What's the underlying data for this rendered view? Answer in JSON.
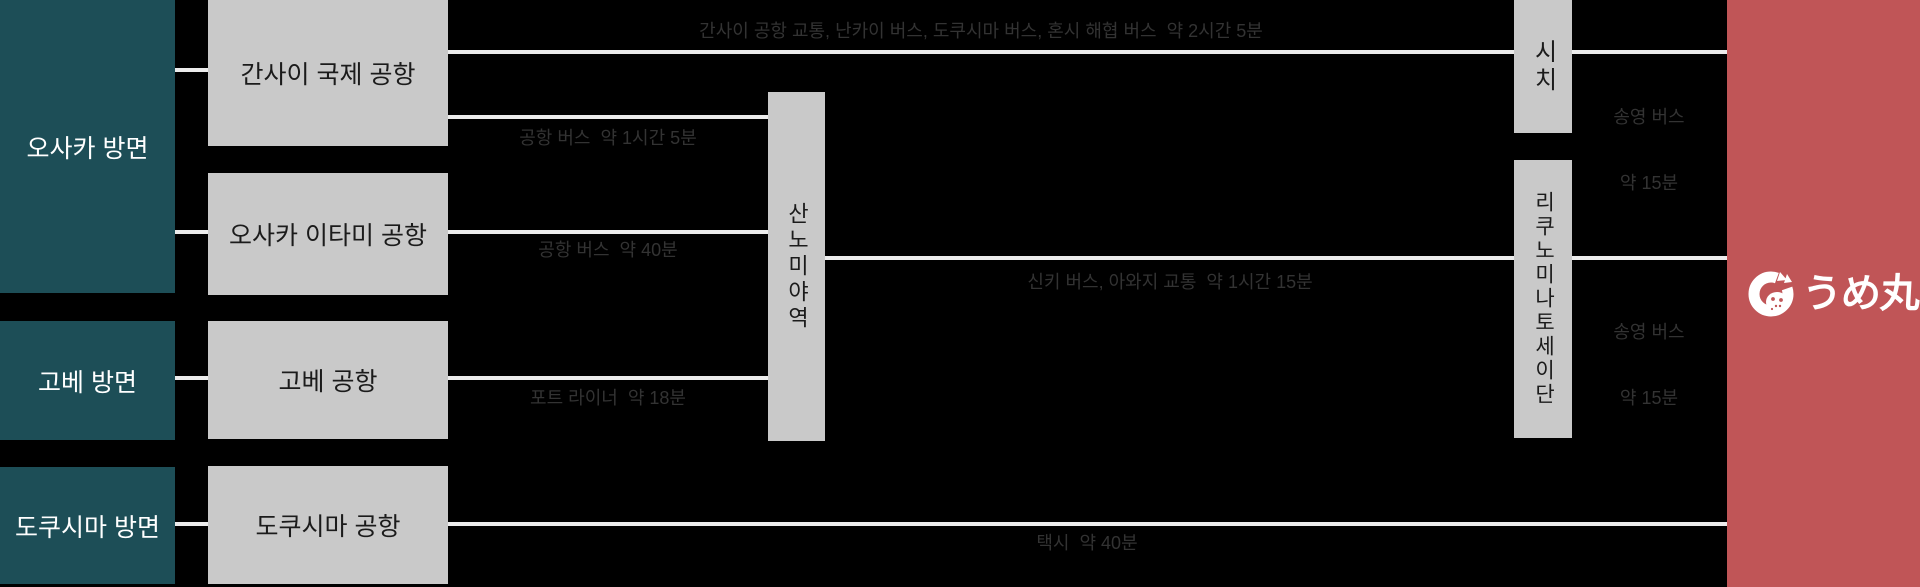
{
  "origins": {
    "osaka": "오사카 방면",
    "kobe": "고베 방면",
    "tokushima": "도쿠시마 방면"
  },
  "airports": {
    "kansai": "간사이 국제 공항",
    "itami": "오사카 이타미 공항",
    "kobe": "고베 공항",
    "tokushima": "도쿠시마 공항"
  },
  "stops": {
    "sannomiya": "산노미야역",
    "shichi": "시치",
    "rikunominatoseidan": "리쿠노미나토세이단"
  },
  "routes": {
    "kansai_highway_bus": "간사이 공항 교통, 난카이 버스, 도쿠시마 버스, 혼시 해협 버스  약 2시간 5분",
    "kansai_airport_bus": "공항 버스  약 1시간 5분",
    "itami_airport_bus": "공항 버스  약 40분",
    "port_liner": "포트 라이너  약 18분",
    "shinki_bus": "신키 버스, 아와지 교통  약 1시간 15분",
    "taxi": "택시  약 40분",
    "shuttle_top_line1": "송영 버스",
    "shuttle_top_line2": "약 15분",
    "shuttle_mid_line1": "송영 버스",
    "shuttle_mid_line2": "약 15분"
  },
  "destination": {
    "logo_text": "うめ丸"
  },
  "colors": {
    "background": "#000000",
    "origin_box": "#1d4e57",
    "stop_box": "#c9c9c9",
    "destination_box": "#c05557",
    "connector_line": "#ececec",
    "route_label_text": "#333333"
  }
}
